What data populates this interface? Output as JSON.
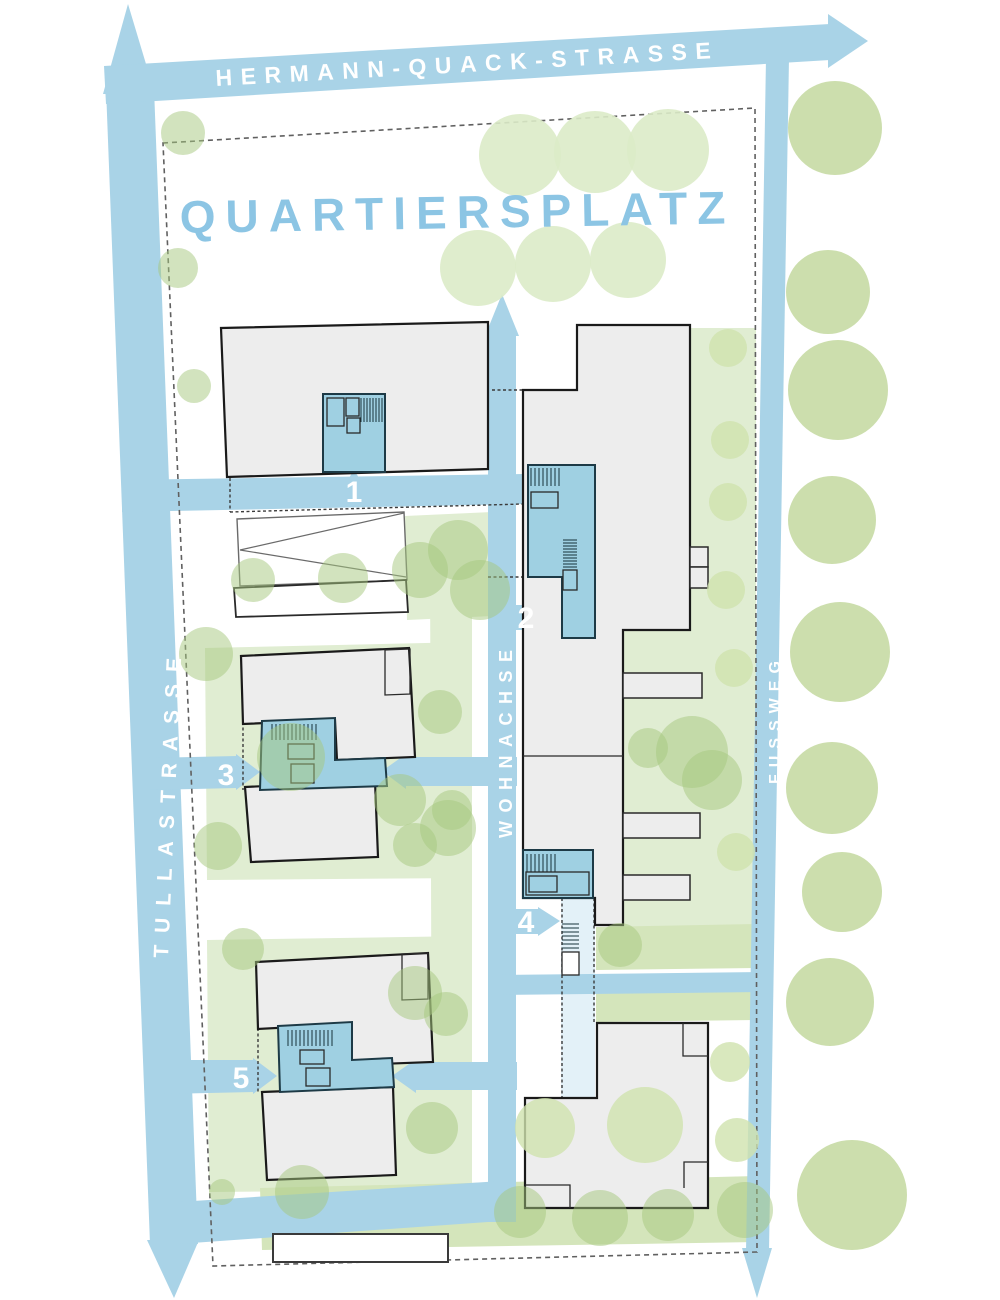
{
  "plan": {
    "plaza_label": "QUARTIERSPLATZ",
    "streets": {
      "top": "HERMANN-QUACK-STRASSE",
      "left": "TULLASTRASSE",
      "center": "WOHNACHSE",
      "right": "FUSSWEG"
    },
    "entrance_markers": [
      {
        "number": "1"
      },
      {
        "number": "2"
      },
      {
        "number": "3"
      },
      {
        "number": "4"
      },
      {
        "number": "5"
      }
    ]
  },
  "colors": {
    "street-blue": "#a9d3e7",
    "core-blue": "#9fd0e2",
    "corridor-blue": "#e3f1f8",
    "plaza-text-blue": "#8cc5e4",
    "building-grey": "#ededed",
    "outline-dark": "#1a1a1a",
    "tree-green-mid": "#a5c87e",
    "tree-green-pale": "#cfe2ae",
    "tree-green-faint": "#dcebc8",
    "tree-green-column": "#c3d89f",
    "ground-green": "#e0edd2",
    "ground-green-strong": "#d4e5bb",
    "label-white": "#ffffff",
    "boundary-grey": "#606060"
  }
}
